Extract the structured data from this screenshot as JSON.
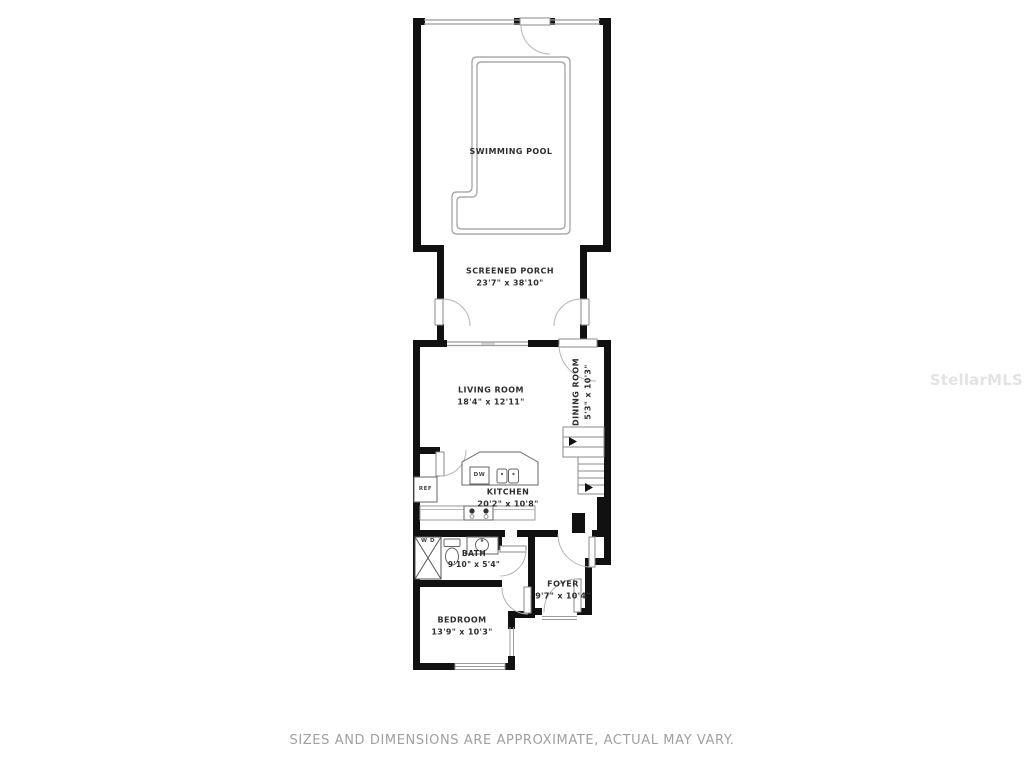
{
  "rooms": {
    "swimming_pool": {
      "name": "SWIMMING POOL",
      "dims": ""
    },
    "screened_porch": {
      "name": "SCREENED PORCH",
      "dims": "23'7\" x 38'10\""
    },
    "living_room": {
      "name": "LIVING ROOM",
      "dims": "18'4\" x 12'11\""
    },
    "dining_room": {
      "name": "DINING ROOM",
      "dims": "5'3\" x 10'3\""
    },
    "kitchen": {
      "name": "KITCHEN",
      "dims": "20'2\" x 10'8\""
    },
    "bath": {
      "name": "BATH",
      "dims": "9'10\" x 5'4\""
    },
    "foyer": {
      "name": "FOYER",
      "dims": "9'7\" x 10'4\""
    },
    "bedroom": {
      "name": "BEDROOM",
      "dims": "13'9\" x 10'3\""
    }
  },
  "fixtures": {
    "refrigerator": "REF",
    "dishwasher": "DW",
    "washer_dryer": "W D"
  },
  "footer": {
    "disclaimer": "SIZES AND DIMENSIONS ARE APPROXIMATE, ACTUAL MAY VARY."
  },
  "watermark": "StellarMLS",
  "colors": {
    "wall": "#111111",
    "fixture_line": "#666666",
    "light_line": "#aaaaaa",
    "label_text": "#2e2e2e",
    "disclaimer_text": "#a0a0a0",
    "watermark_text": "#e3e3e3"
  }
}
